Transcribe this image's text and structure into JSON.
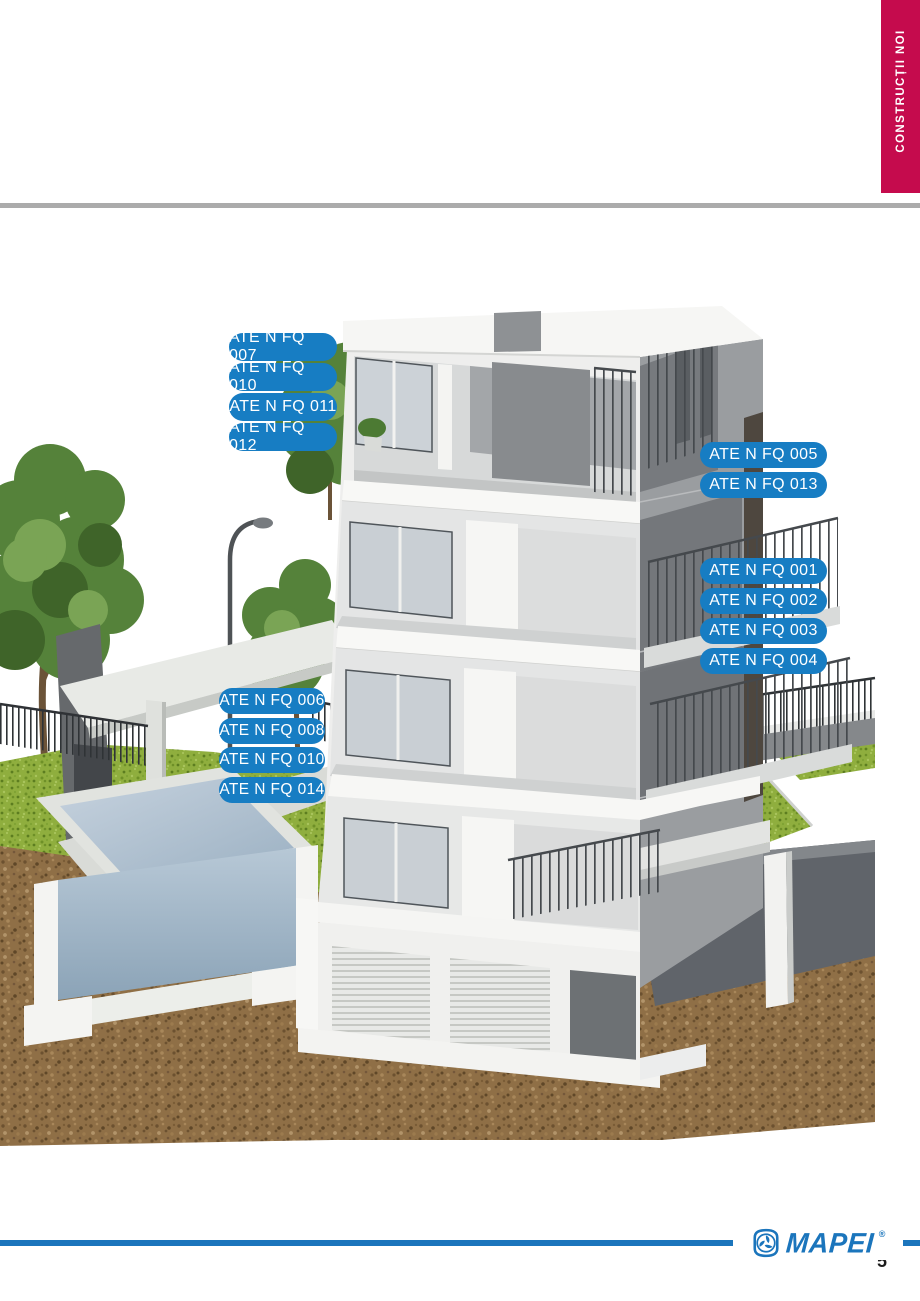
{
  "page": {
    "side_tab": "CONSTRUCȚII NOI",
    "page_number": "5",
    "brand": "MAPEI",
    "brand_registered": "®"
  },
  "labels": {
    "group_top_left": [
      "ATE N FQ 007",
      "ATE N FQ 010",
      "ATE N FQ 011",
      "ATE N FQ 012"
    ],
    "group_right_upper": [
      "ATE N FQ 005",
      "ATE N FQ 013"
    ],
    "group_right_lower": [
      "ATE N FQ 001",
      "ATE N FQ 002",
      "ATE N FQ 003",
      "ATE N FQ 004"
    ],
    "group_left_middle": [
      "ATE N FQ 006",
      "ATE N FQ 008",
      "ATE N FQ 010",
      "ATE N FQ 014"
    ]
  },
  "colors": {
    "label_blue": "#177dc3",
    "banner_red": "#c50b4d",
    "rule_gray": "#ababab",
    "brand_blue": "#1b75bc"
  }
}
